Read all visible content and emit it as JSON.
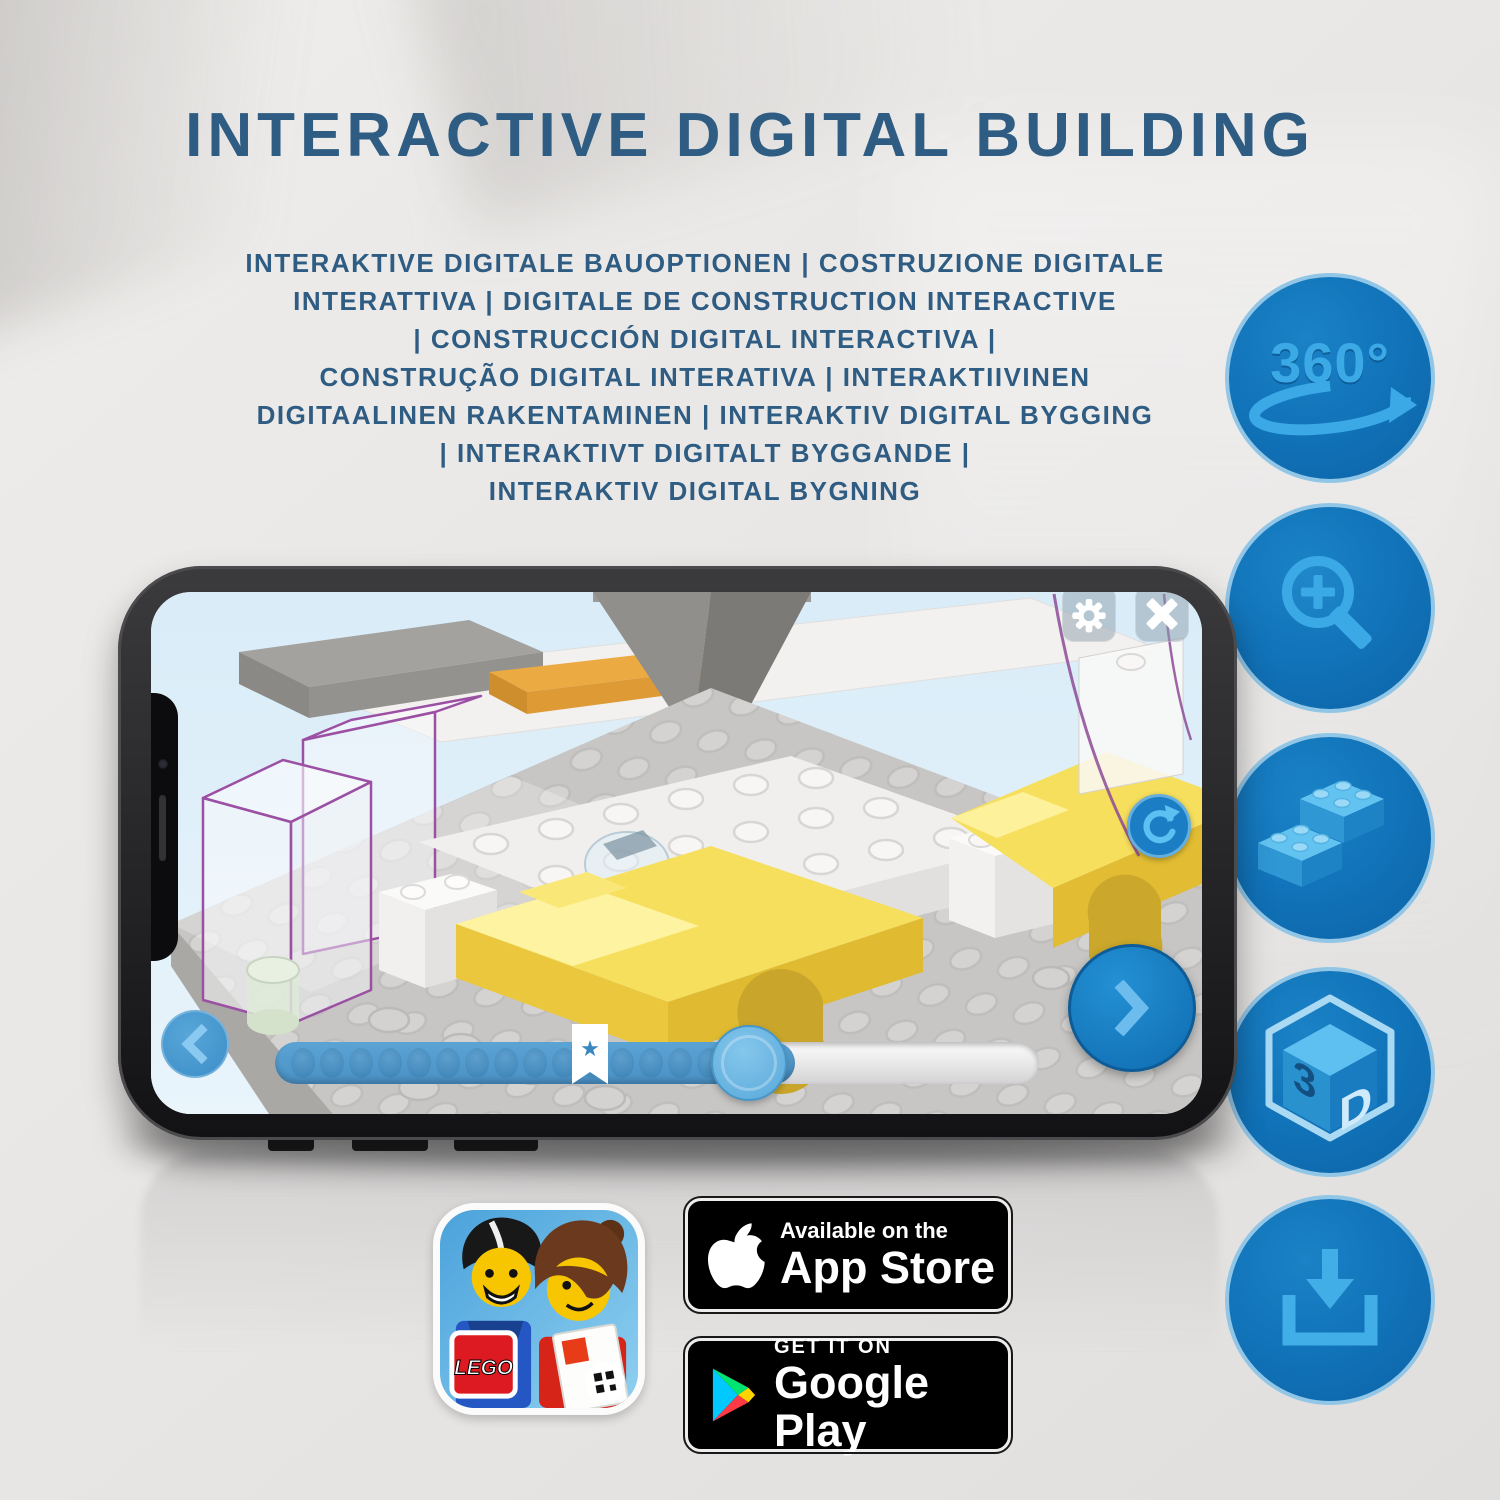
{
  "header": {
    "title": "INTERACTIVE DIGITAL BUILDING"
  },
  "subtitle": {
    "lines": [
      "INTERAKTIVE DIGITALE BAUOPTIONEN | COSTRUZIONE DIGITALE",
      "INTERATTIVA | DIGITALE DE CONSTRUCTION INTERACTIVE",
      "| CONSTRUCCIÓN DIGITAL INTERACTIVA |",
      "CONSTRUÇÃO DIGITAL INTERATIVA | INTERAKTIIVINEN",
      "DIGITAALINEN RAKENTAMINEN | INTERAKTIV DIGITAL BYGGING",
      "| INTERAKTIVT DIGITALT BYGGANDE |",
      "INTERAKTIV DIGITAL BYGNING"
    ]
  },
  "feature_icons": [
    {
      "name": "360-rotation-icon",
      "label": "360°"
    },
    {
      "name": "zoom-in-icon"
    },
    {
      "name": "brick-stack-icon"
    },
    {
      "name": "3d-cube-icon",
      "left_char": "3",
      "right_char": "D"
    },
    {
      "name": "download-icon"
    }
  ],
  "phone_app": {
    "toolbar": {
      "settings_icon": "gear-icon",
      "close_icon": "close-icon"
    },
    "viewport": {
      "rotate_icon": "rotate-cw-icon"
    },
    "navigation": {
      "prev_icon": "chevron-left-icon",
      "next_icon": "chevron-right-icon"
    },
    "slider": {
      "dot_count": 17,
      "star_glyph": "★",
      "marker_icon": "star-bookmark-icon"
    }
  },
  "badges": {
    "lego_app": {
      "logo_text": "LEGO"
    },
    "app_store": {
      "tagline": "Available on the",
      "name": "App Store"
    },
    "google_play": {
      "tagline": "GET IT ON",
      "name": "Google Play"
    }
  },
  "colors": {
    "title_blue": "#2e5c82",
    "feature_circle_fill": "#1173b9",
    "feature_circle_border": "#92c6e7",
    "feature_glyph": "#3aa9e5",
    "app_accent_blue": "#1b7ec4",
    "slider_fill": "#4a90c4",
    "highlight_yellow": "#f6df5c",
    "ghost_outline_purple": "#9c50a4"
  }
}
